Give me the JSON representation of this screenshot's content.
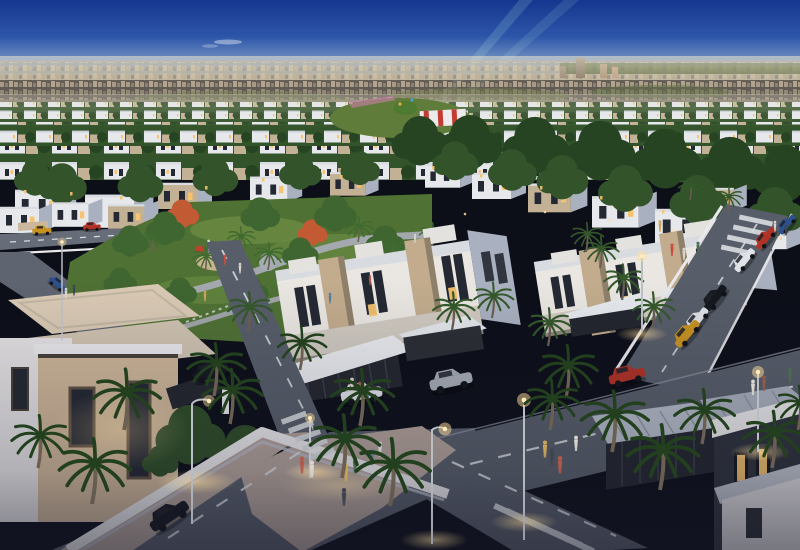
{
  "meta": {
    "title": "Aerial dusk rendering of a suburban villa community with park, roads and distant city skyline"
  },
  "palette": {
    "sky_top": "#16368f",
    "sky_mid": "#2c55a8",
    "sky_low": "#7f9cc6",
    "horizon_haze": "#d9d0b8",
    "city_far": "#a89a85",
    "city_olive": "#6f7a4d",
    "city_green": "#5c6b3b",
    "tower": "#8f7e6c",
    "field_tree": "#33532b",
    "field_tree_dark": "#264422",
    "house_white": "#e6e8ec",
    "house_beige": "#c2b195",
    "villa_side": "#a9b0bf",
    "roof_slab": "#d8dce1",
    "park_green": "#4f7134",
    "park_green_light": "#6b8c42",
    "path_grey": "#a7abb4",
    "sand": "#c6b28c",
    "road": "#575d69",
    "road_dark": "#3f4450",
    "sidewalk": "#b2a29a",
    "wall_white": "#e9e8ea",
    "wall_shade": "#b9bac6",
    "villa_front": "#eae7e2",
    "accent_beige": "#c2ac8d",
    "accent_shade": "#8f8069",
    "lower_band": "#cfc9c0",
    "window_dark": "#242832",
    "window_lit": "#f6c46f",
    "lamp_glow": "#ffdf9e",
    "palm_dark": "#223f1e",
    "palm_mid": "#35582b",
    "palm_park": "#3f6a30",
    "trunk": "#6b5f52",
    "dark_wall": "#2e323c",
    "dark_deep": "#23262e",
    "dark_roof": "#3c404a",
    "canopy": "#b3bac6",
    "car_dark": "#16181f",
    "car_silver": "#a7adb6",
    "car_red": "#b03226",
    "car_white": "#dfe2e6",
    "car_yellow": "#c8921f",
    "car_blue": "#2d4f8a",
    "beam": "#bff7e8",
    "autumn": "#c25a33",
    "tent_red": "#c23c34",
    "crosswalk": "#d8dbdf",
    "warm_roof": "#d9c9b4",
    "warm_wall": "#cdb598"
  }
}
